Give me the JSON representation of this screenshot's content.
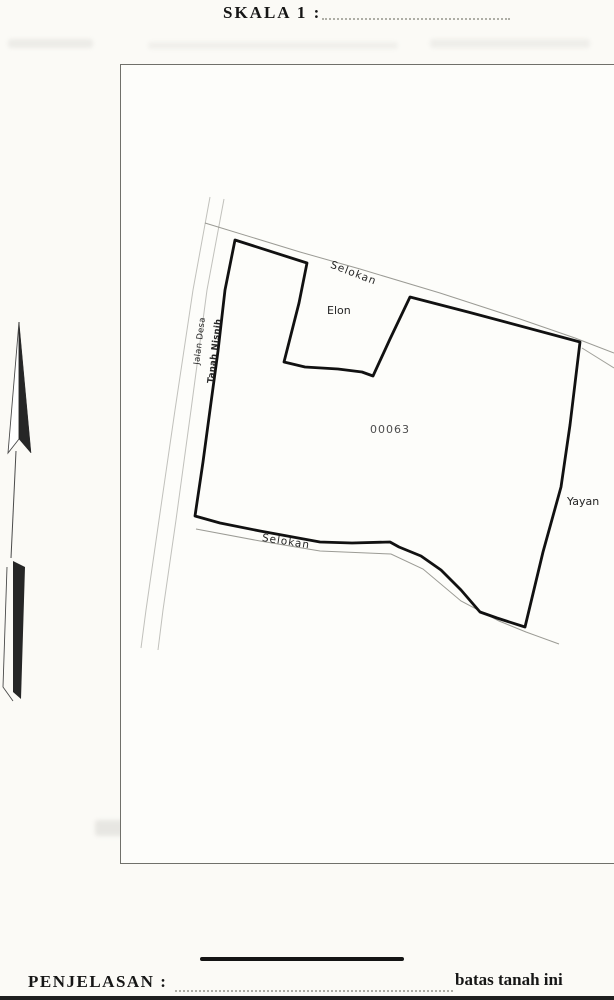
{
  "document": {
    "type": "scanned land survey sketch (Indonesia)",
    "header": {
      "scale_label": "SKALA 1 :",
      "scale_value": ""
    },
    "legend": {
      "title": "PENJELASAN :",
      "symbol": "thick-black-line",
      "boundary_label": "batas tanah ini"
    }
  },
  "map": {
    "labels": {
      "selokan_top": "Selokan",
      "selokan_bottom": "Selokan",
      "elon": "Elon",
      "parcel_number": "00063",
      "yayan": "Yayan",
      "road": "Jalan Desa",
      "adjacent_owner": "Tanah Nisnih"
    },
    "features": {
      "north_arrow": "north-arrow",
      "parcel_boundary": "thick black closed polygon",
      "ditches": "thin double lines labelled Selokan",
      "road": "thin double lines labelled Jalan Desa"
    }
  },
  "colors": {
    "paper": "#fbfaf6",
    "map_paper": "#fdfdfa",
    "ink": "#111111",
    "thin_line": "#8a8a82",
    "frame": "#70706a",
    "ghost": "#b3b3ae"
  }
}
